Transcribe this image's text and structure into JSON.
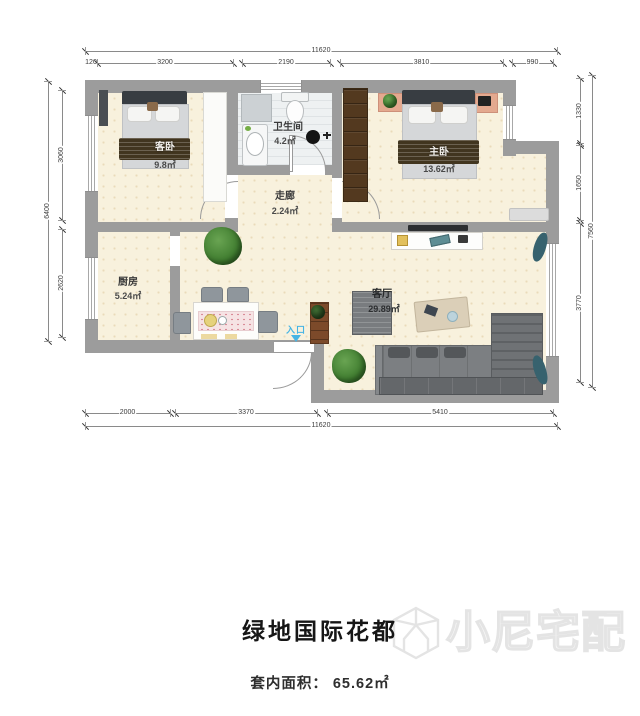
{
  "title_block": {
    "title": "绿地国际花都",
    "area_label": "套内面积：",
    "area_value": "65.62㎡"
  },
  "watermark": {
    "brand": "小尼宅配"
  },
  "entry": {
    "label": "入口"
  },
  "rooms": {
    "second_bedroom": {
      "name": "客卧",
      "area": "9.8㎡"
    },
    "bathroom": {
      "name": "卫生间",
      "area": "4.2㎡"
    },
    "corridor": {
      "name": "走廊",
      "area": "2.24㎡"
    },
    "master_bedroom": {
      "name": "主卧",
      "area": "13.62㎡"
    },
    "kitchen": {
      "name": "厨房",
      "area": "5.24㎡"
    },
    "living_room": {
      "name": "客厅",
      "area": "29.89㎡"
    }
  },
  "dimensions_mm": {
    "top_total": "11620",
    "top_segments": [
      "120",
      "3200",
      "2190",
      "3810",
      "990"
    ],
    "left_total": "6400",
    "left_segments": [
      "3060",
      "2620"
    ],
    "right_total": "7560",
    "right_segments": [
      "1330",
      "1650",
      "3770"
    ],
    "bottom_total": "11620",
    "bottom_segments": [
      "2000",
      "3370",
      "5410"
    ]
  },
  "dims_render": [
    {
      "dir": "h",
      "x1": 85,
      "x2": 557,
      "y": 51,
      "label": "11620"
    },
    {
      "dir": "h",
      "x1": 88,
      "x2": 94,
      "y": 63,
      "label": "120"
    },
    {
      "dir": "h",
      "x1": 97,
      "x2": 233,
      "y": 63,
      "label": "3200"
    },
    {
      "dir": "h",
      "x1": 242,
      "x2": 330,
      "y": 63,
      "label": "2190"
    },
    {
      "dir": "h",
      "x1": 340,
      "x2": 503,
      "y": 63,
      "label": "3810"
    },
    {
      "dir": "h",
      "x1": 512,
      "x2": 553,
      "y": 63,
      "label": "990"
    },
    {
      "dir": "v",
      "x": 48,
      "y1": 81,
      "y2": 341,
      "label": "6400"
    },
    {
      "dir": "v",
      "x": 62,
      "y1": 90,
      "y2": 220,
      "label": "3060"
    },
    {
      "dir": "v",
      "x": 62,
      "y1": 229,
      "y2": 337,
      "label": "2620"
    },
    {
      "dir": "v",
      "x": 580,
      "y1": 78,
      "y2": 143,
      "label": "1330"
    },
    {
      "dir": "v",
      "x": 580,
      "y1": 145,
      "y2": 220,
      "label": "1650"
    },
    {
      "dir": "v",
      "x": 580,
      "y1": 223,
      "y2": 382,
      "label": "3770"
    },
    {
      "dir": "v",
      "x": 592,
      "y1": 75,
      "y2": 387,
      "label": "7560"
    },
    {
      "dir": "h",
      "x1": 85,
      "x2": 170,
      "y": 413,
      "label": "2000"
    },
    {
      "dir": "h",
      "x1": 175,
      "x2": 317,
      "y": 413,
      "label": "3370"
    },
    {
      "dir": "h",
      "x1": 327,
      "x2": 553,
      "y": 413,
      "label": "5410"
    },
    {
      "dir": "h",
      "x1": 85,
      "x2": 557,
      "y": 426,
      "label": "11620"
    }
  ],
  "colors": {
    "wall": "#9c9c9c",
    "floor_beige": "#f8f1dd",
    "bath_floor": "#eef1f2",
    "entry_accent": "#45b4e4",
    "sofa_gray": "#7c7f82",
    "wardrobe_brown": "#53391f"
  }
}
